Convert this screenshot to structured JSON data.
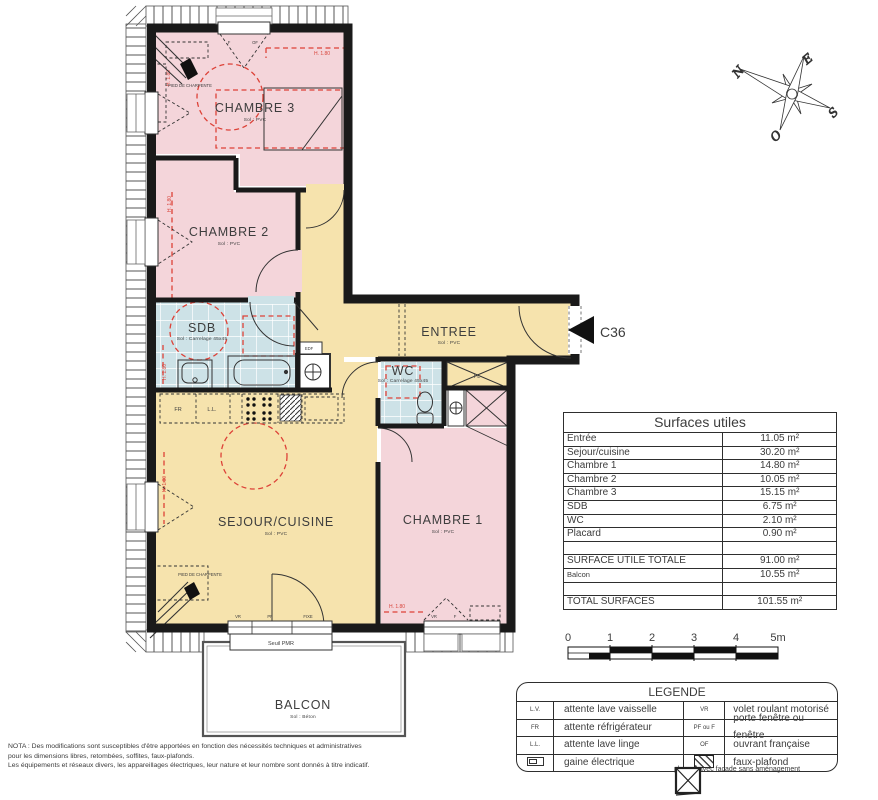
{
  "plan": {
    "rooms": {
      "chambre3": {
        "name": "CHAMBRE 3",
        "floor": "Sol : PVC"
      },
      "chambre2": {
        "name": "CHAMBRE 2",
        "floor": "Sol : PVC"
      },
      "chambre1": {
        "name": "CHAMBRE 1",
        "floor": "Sol : PVC"
      },
      "sejour": {
        "name": "SEJOUR/CUISINE",
        "floor": "Sol : PVC"
      },
      "entree": {
        "name": "ENTREE",
        "floor": "Sol : PVC"
      },
      "sdb": {
        "name": "SDB",
        "floor": "Sol : Carrelage 45x45"
      },
      "wc": {
        "name": "WC",
        "floor": "Sol : Carrelage 45x45"
      },
      "balcon": {
        "name": "BALCON",
        "floor": "Sol : Béton"
      }
    },
    "annotations": {
      "height_line": "H. 1.80",
      "pied_de_charpente": "PIED DE CHARPENTE",
      "edf": "EDF",
      "pl": "PL",
      "fr": "FR",
      "ll": "L.L.",
      "vr": "VR",
      "pf": "PF",
      "fixe": "FIXE",
      "f": "F",
      "of": "OF",
      "seuil_pmr": "Seuil PMR",
      "unit": "C36"
    },
    "compass": {
      "n": "N",
      "e": "E",
      "s": "S",
      "o": "O"
    }
  },
  "surfaces_table": {
    "title": "Surfaces utiles",
    "rows": [
      {
        "label": "Entrée",
        "value": "11.05 m²"
      },
      {
        "label": "Sejour/cuisine",
        "value": "30.20 m²"
      },
      {
        "label": "Chambre 1",
        "value": "14.80 m²"
      },
      {
        "label": "Chambre 2",
        "value": "10.05 m²"
      },
      {
        "label": "Chambre 3",
        "value": "15.15 m²"
      },
      {
        "label": "SDB",
        "value": "6.75 m²"
      },
      {
        "label": "WC",
        "value": "2.10 m²"
      },
      {
        "label": "Placard",
        "value": "0.90 m²"
      },
      {
        "label": "",
        "value": ""
      },
      {
        "label": "SURFACE UTILE TOTALE",
        "value": "91.00 m²"
      },
      {
        "label": "Balcon",
        "value": "10.55 m²"
      },
      {
        "label": "",
        "value": ""
      },
      {
        "label": "TOTAL SURFACES",
        "value": "101.55 m²"
      }
    ]
  },
  "scale_bar": {
    "ticks": [
      "0",
      "1",
      "2",
      "3",
      "4",
      "5m"
    ]
  },
  "legend": {
    "title": "LEGENDE",
    "rows": [
      {
        "key": "L.V.",
        "label": "attente lave vaisselle",
        "key2": "VR",
        "label2": "volet roulant motorisé"
      },
      {
        "key": "FR",
        "label": "attente réfrigérateur",
        "key2": "PF ou F",
        "label2": "porte fenêtre ou fenêtre"
      },
      {
        "key": "L.L.",
        "label": "attente lave linge",
        "key2": "OF",
        "label2": "ouvrant française"
      },
      {
        "key": "",
        "label": "gaine électrique",
        "key2": "",
        "label2": "faux-plafond"
      }
    ],
    "extra": "placard avec facade sans aménagement"
  },
  "nota": {
    "line1": "NOTA : Des modifications sont susceptibles d'être apportées en fonction des nécessités techniques et administratives",
    "line2": "pour les dimensions libres, retombées, soffites, faux-plafonds.",
    "line3": "Les équipements et réseaux divers, les appareillages électriques, leur nature et leur nombre sont donnés à titre indicatif."
  },
  "colors": {
    "room_pink": "#f4d5da",
    "room_yellow": "#f6e3ad",
    "room_tile": "#cde2e7",
    "wall": "#1a1a1a",
    "red_dash": "#dd4238"
  }
}
